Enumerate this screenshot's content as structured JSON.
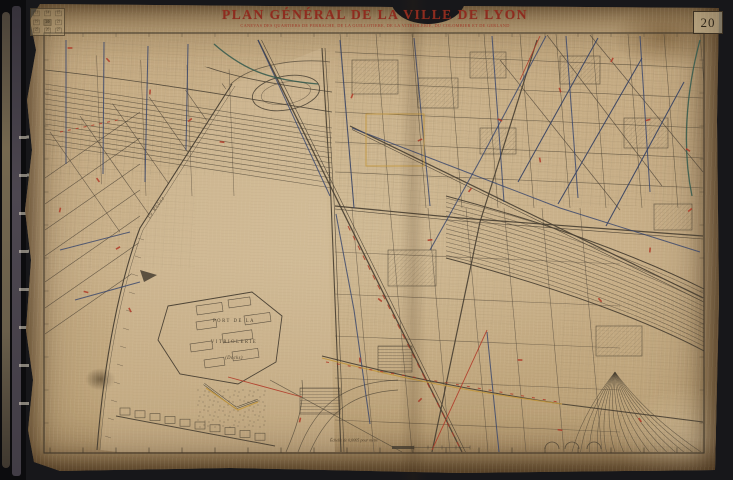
{
  "header": {
    "title": "PLAN GÉNÉRAL DE LA VILLE DE LYON",
    "subtitle": "CANEVAS DES QUARTIERS DE PERRACHE, DE LA GUILLOTIÈRE, DE LA VITRIOLERIE, DU COLOMBIER ET DE GERLAND"
  },
  "sheet": {
    "number": "20"
  },
  "index_stamp": {
    "grid": [
      [
        "13",
        "14",
        "15"
      ],
      [
        "19",
        "20",
        "21"
      ],
      [
        "25",
        "26",
        "27"
      ]
    ],
    "current": "20"
  },
  "map_labels": {
    "port_line1": "PORT DE LA",
    "port_line2": "VITRIOLERIE",
    "port_line3": "(Docks)",
    "river": "Le Rhône"
  },
  "scale": {
    "text": "Échelle de 0,0005 pour mètre"
  },
  "icons": {
    "flow_arrow": "river-flow-arrow"
  },
  "colors": {
    "bg": "#17171a",
    "paper": "#c6ac84",
    "paper_light": "#d7c49f",
    "ink": "#473e31",
    "ink_light": "#6b5f4c",
    "red_title": "#8e2c1f",
    "red_line": "#b03a28",
    "blue": "#35446b",
    "teal": "#31584c",
    "yellow": "#c2973d",
    "frame": "#3a3226"
  }
}
